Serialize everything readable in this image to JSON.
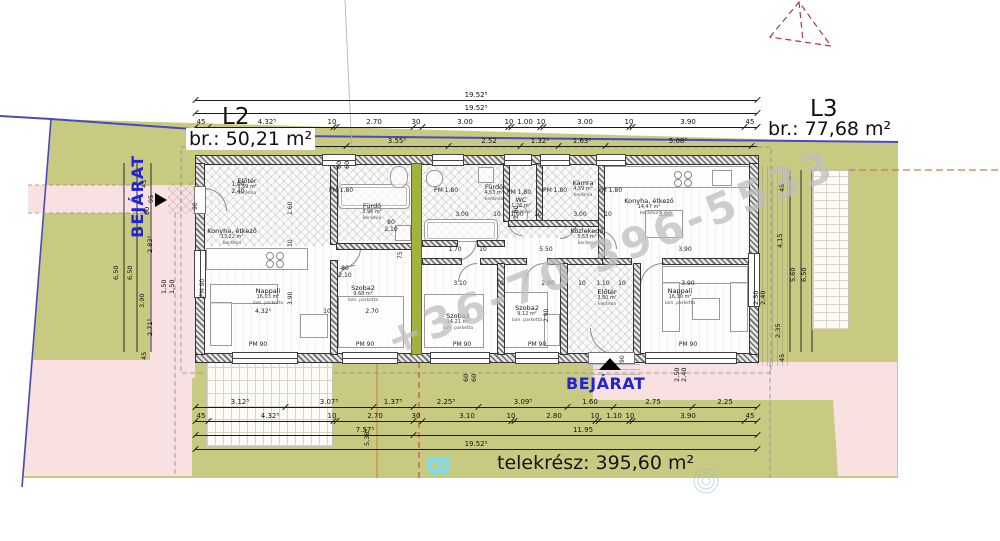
{
  "titles": {
    "l2": "L2",
    "l2_area": "br.: 50,21 m²",
    "l3": "L3",
    "l3_area": "br.: 77,68 m²",
    "telekresz": "telekrész: 395,60 m²",
    "bejarat_left": "BEJÁRAT",
    "bejarat_bottom": "BEJÁRAT",
    "watermark_phone": "+36-70 396-5533",
    "watermark_b": "B"
  },
  "colors": {
    "site_green": "#c9ca82",
    "zone_pink": "#f8e1e0",
    "party_wall_olive": "#a4b140",
    "boundary_blue": "#4a4ac0",
    "roof_red": "#b03545",
    "entrance_blue": "#2323d6"
  },
  "dim_rows": [
    {
      "y": 100,
      "x1": 195,
      "x2": 757,
      "ticks": [
        195,
        757
      ],
      "labels": [
        {
          "t": "19.52⁵",
          "x": 476
        }
      ]
    },
    {
      "y": 113,
      "x1": 195,
      "x2": 757,
      "ticks": [
        195,
        757
      ],
      "labels": [
        {
          "t": "19.52⁵",
          "x": 476
        }
      ]
    },
    {
      "y": 127,
      "x1": 195,
      "x2": 757,
      "ticks": [
        195,
        208,
        333,
        336,
        413,
        422,
        508,
        511,
        540,
        543,
        629,
        632,
        744,
        757
      ],
      "labels": [
        {
          "t": "45",
          "x": 201
        },
        {
          "t": "4.32⁵",
          "x": 267
        },
        {
          "t": "10",
          "x": 332
        },
        {
          "t": "2.70",
          "x": 374
        },
        {
          "t": "30",
          "x": 416
        },
        {
          "t": "3.00",
          "x": 465
        },
        {
          "t": "10",
          "x": 509
        },
        {
          "t": "1.00",
          "x": 525
        },
        {
          "t": "10",
          "x": 541
        },
        {
          "t": "3.00",
          "x": 585
        },
        {
          "t": "10",
          "x": 629
        },
        {
          "t": "3.90",
          "x": 688
        },
        {
          "t": "45",
          "x": 750
        }
      ]
    },
    {
      "y": 146,
      "x1": 306,
      "x2": 757,
      "ticks": [
        306,
        346,
        448,
        520,
        558,
        605,
        751
      ],
      "labels": [
        {
          "t": "40⁵",
          "x": 281
        },
        {
          "t": "3.55⁵",
          "x": 397
        },
        {
          "t": "2.52",
          "x": 489
        },
        {
          "t": "1.32⁵",
          "x": 540
        },
        {
          "t": "1.63⁵",
          "x": 582
        },
        {
          "t": "5.08⁵",
          "x": 678
        }
      ]
    },
    {
      "y": 407,
      "x1": 195,
      "x2": 757,
      "ticks": [
        195,
        285,
        373,
        413,
        478,
        567,
        613,
        692,
        757
      ],
      "labels": [
        {
          "t": "3.12⁵",
          "x": 240
        },
        {
          "t": "3.07⁵",
          "x": 329
        },
        {
          "t": "1.37⁵",
          "x": 393
        },
        {
          "t": "2.25⁵",
          "x": 446
        },
        {
          "t": "3.09⁵",
          "x": 523
        },
        {
          "t": "1.60",
          "x": 590
        },
        {
          "t": "2.75",
          "x": 653
        },
        {
          "t": "2.25",
          "x": 725
        }
      ]
    },
    {
      "y": 421,
      "x1": 195,
      "x2": 757,
      "ticks": [
        195,
        208,
        333,
        336,
        413,
        422,
        511,
        514,
        595,
        598,
        629,
        632,
        744,
        757
      ],
      "labels": [
        {
          "t": "45",
          "x": 201
        },
        {
          "t": "4.32⁵",
          "x": 270
        },
        {
          "t": "10",
          "x": 332
        },
        {
          "t": "2.70",
          "x": 375
        },
        {
          "t": "30",
          "x": 416
        },
        {
          "t": "3.10",
          "x": 467
        },
        {
          "t": "10",
          "x": 511
        },
        {
          "t": "2.80",
          "x": 554
        },
        {
          "t": "10",
          "x": 595
        },
        {
          "t": "1.10",
          "x": 614
        },
        {
          "t": "10",
          "x": 630
        },
        {
          "t": "3.90",
          "x": 688
        },
        {
          "t": "45",
          "x": 750
        }
      ]
    },
    {
      "y": 435,
      "x1": 195,
      "x2": 757,
      "ticks": [
        195,
        413,
        757
      ],
      "labels": [
        {
          "t": "7.57⁵",
          "x": 365
        },
        {
          "t": "11.95",
          "x": 583
        }
      ]
    },
    {
      "y": 449,
      "x1": 195,
      "x2": 757,
      "ticks": [
        195,
        757
      ],
      "labels": [
        {
          "t": "19.52⁵",
          "x": 476
        }
      ]
    }
  ],
  "side_dims": [
    {
      "t": "6,50",
      "x": 120,
      "y": 272
    },
    {
      "t": "6,50",
      "x": 134,
      "y": 272
    },
    {
      "t": "45",
      "x": 148,
      "y": 180
    },
    {
      "t": "95",
      "x": 155,
      "y": 195
    },
    {
      "t": "2,83⁵",
      "x": 154,
      "y": 245
    },
    {
      "t": "3,90",
      "x": 146,
      "y": 300
    },
    {
      "t": "2,71⁵",
      "x": 154,
      "y": 328
    },
    {
      "t": "45",
      "x": 148,
      "y": 352
    },
    {
      "t": "1,50",
      "x": 168,
      "y": 286
    },
    {
      "t": "1,50",
      "x": 176,
      "y": 286
    },
    {
      "t": "60",
      "x": 151,
      "y": 207
    },
    {
      "t": "45",
      "x": 786,
      "y": 184
    },
    {
      "t": "4,15",
      "x": 784,
      "y": 240
    },
    {
      "t": "2,35",
      "x": 782,
      "y": 330
    },
    {
      "t": "45",
      "x": 786,
      "y": 354
    },
    {
      "t": "5,60",
      "x": 797,
      "y": 274
    },
    {
      "t": "6,50",
      "x": 808,
      "y": 274
    },
    {
      "t": "5,38⁵",
      "x": 371,
      "y": 438
    },
    {
      "t": "2,50",
      "x": 681,
      "y": 374
    },
    {
      "t": "2,40",
      "x": 688,
      "y": 374
    },
    {
      "t": "2,50",
      "x": 760,
      "y": 297
    },
    {
      "t": "2,40",
      "x": 767,
      "y": 297
    },
    {
      "t": "60",
      "x": 343,
      "y": 161
    },
    {
      "t": "60",
      "x": 351,
      "y": 161
    },
    {
      "t": "60",
      "x": 470,
      "y": 374
    },
    {
      "t": "60",
      "x": 478,
      "y": 374
    }
  ],
  "inner_dims": [
    {
      "t": "3.00",
      "x": 462,
      "y": 211
    },
    {
      "t": "10",
      "x": 497,
      "y": 211
    },
    {
      "t": "1.00",
      "x": 517,
      "y": 211
    },
    {
      "t": "10",
      "x": 538,
      "y": 211
    },
    {
      "t": "3.00",
      "x": 580,
      "y": 211
    },
    {
      "t": "10",
      "x": 608,
      "y": 211
    },
    {
      "t": "3.90",
      "x": 665,
      "y": 211
    },
    {
      "t": "1.70",
      "x": 455,
      "y": 246
    },
    {
      "t": "10",
      "x": 483,
      "y": 246
    },
    {
      "t": "5.50",
      "x": 546,
      "y": 246
    },
    {
      "t": "3.90",
      "x": 685,
      "y": 246
    },
    {
      "t": "3.10",
      "x": 460,
      "y": 280
    },
    {
      "t": "10",
      "x": 500,
      "y": 280
    },
    {
      "t": "2.80",
      "x": 548,
      "y": 280
    },
    {
      "t": "10",
      "x": 582,
      "y": 280
    },
    {
      "t": "1.10",
      "x": 603,
      "y": 280
    },
    {
      "t": "10",
      "x": 622,
      "y": 280
    },
    {
      "t": "3.90",
      "x": 688,
      "y": 280
    },
    {
      "t": "4.32⁵",
      "x": 263,
      "y": 308
    },
    {
      "t": "10",
      "x": 327,
      "y": 308
    },
    {
      "t": "2.70",
      "x": 372,
      "y": 308
    },
    {
      "t": "1.60",
      "x": 294,
      "y": 208,
      "r": 1
    },
    {
      "t": "10",
      "x": 294,
      "y": 240,
      "r": 1
    },
    {
      "t": "3.90",
      "x": 294,
      "y": 298,
      "r": 1
    },
    {
      "t": "2.00",
      "x": 520,
      "y": 212,
      "r": 1
    },
    {
      "t": "2.90",
      "x": 550,
      "y": 315,
      "r": 1
    },
    {
      "t": "75",
      "x": 404,
      "y": 252,
      "r": 1
    },
    {
      "t": "1,00",
      "x": 238,
      "y": 181
    },
    {
      "t": "2,40",
      "x": 238,
      "y": 188
    },
    {
      "t": "80",
      "x": 345,
      "y": 265
    },
    {
      "t": "2,10",
      "x": 345,
      "y": 272
    },
    {
      "t": "80",
      "x": 391,
      "y": 219
    },
    {
      "t": "2,10",
      "x": 391,
      "y": 226
    }
  ],
  "window_labels": [
    {
      "t": "PM 1,80",
      "x": 341,
      "y": 187
    },
    {
      "t": "PM 1,80",
      "x": 446,
      "y": 187
    },
    {
      "t": "PM 1,80",
      "x": 519,
      "y": 189
    },
    {
      "t": "PM 1,80",
      "x": 555,
      "y": 187
    },
    {
      "t": "PM 1,80",
      "x": 610,
      "y": 187
    },
    {
      "t": "PM 90",
      "x": 258,
      "y": 341
    },
    {
      "t": "PM 90",
      "x": 365,
      "y": 341
    },
    {
      "t": "PM 90",
      "x": 462,
      "y": 341
    },
    {
      "t": "PM 90",
      "x": 537,
      "y": 341
    },
    {
      "t": "PM 90",
      "x": 688,
      "y": 341
    },
    {
      "t": "PM 90",
      "x": 206,
      "y": 290,
      "r": 1
    },
    {
      "t": "90",
      "x": 199,
      "y": 203,
      "r": 1
    },
    {
      "t": "90",
      "x": 626,
      "y": 356,
      "r": 1
    }
  ],
  "rooms": [
    {
      "name": "Előtér",
      "area": "3,59 m²",
      "floor": "kerámia",
      "x": 247,
      "y": 178
    },
    {
      "name": "Konyha, étkező",
      "area": "13,22 m²",
      "floor": "kerámia",
      "x": 232,
      "y": 228
    },
    {
      "name": "Nappali",
      "area": "16,03 m²",
      "floor": "lam. parketta",
      "x": 268,
      "y": 288
    },
    {
      "name": "Fürdő",
      "area": "3,96 m²",
      "floor": "kerámia",
      "x": 372,
      "y": 203
    },
    {
      "name": "Szoba2",
      "area": "9,68 m²",
      "floor": "lam. parketta",
      "x": 363,
      "y": 285
    },
    {
      "name": "Fürdő",
      "area": "4,53 m²",
      "floor": "kerámia",
      "x": 494,
      "y": 184
    },
    {
      "name": "WC",
      "area": "1,76 m²",
      "floor": "kerámia",
      "x": 521,
      "y": 197
    },
    {
      "name": "Kamra",
      "area": "4,59 m²",
      "floor": "kerámia",
      "x": 583,
      "y": 180
    },
    {
      "name": "Konyha, étkező",
      "area": "14,47 m²",
      "floor": "kerámia",
      "x": 649,
      "y": 198
    },
    {
      "name": "Közlekedő",
      "area": "5,53 m²",
      "floor": "kerámia",
      "x": 587,
      "y": 228
    },
    {
      "name": "Szoba2",
      "area": "14,21 m²",
      "floor": "lam. parketta",
      "x": 458,
      "y": 313
    },
    {
      "name": "Szoba2",
      "area": "9,12 m²",
      "floor": "lam. parketta",
      "x": 527,
      "y": 305
    },
    {
      "name": "Előtér",
      "area": "3,50 m²",
      "floor": "kerámia",
      "x": 607,
      "y": 289
    },
    {
      "name": "Nappali",
      "area": "16,30 m²",
      "floor": "lam. parketta",
      "x": 680,
      "y": 288
    }
  ]
}
